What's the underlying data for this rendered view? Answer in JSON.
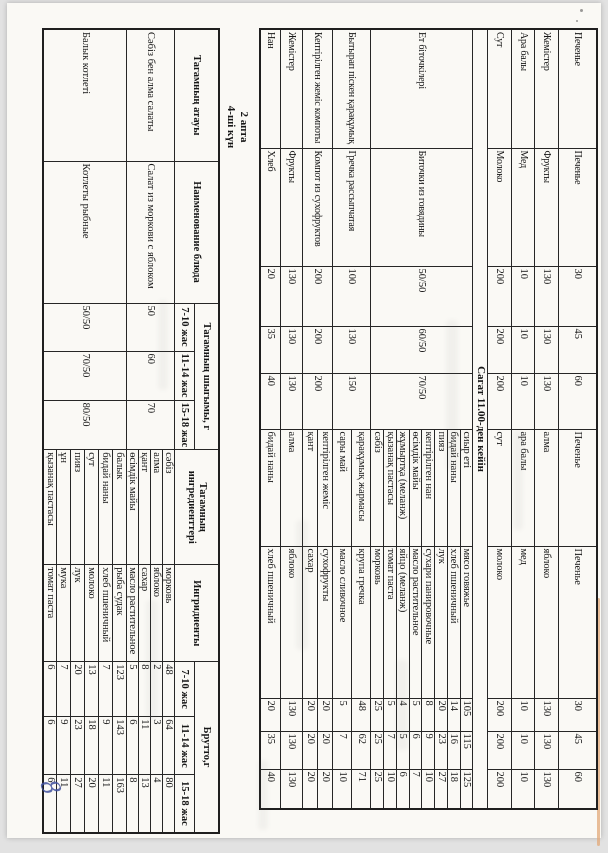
{
  "page": {
    "background_color": "#e2e2e2",
    "paper_color": "#faf9f5",
    "ink_color": "#171717",
    "handwriting_color": "#41519e",
    "handwritten_page_number": "8"
  },
  "menu_table": {
    "rows": [
      {
        "kz": "Печенье",
        "ru": "Печенье",
        "portions": [
          "30",
          "45",
          "60"
        ],
        "ingredients": [
          {
            "kz": "Печенье",
            "ru": "Печенье",
            "brutto": [
              "30",
              "45",
              "60"
            ]
          }
        ]
      },
      {
        "kz": "Жемістер",
        "ru": "Фрукты",
        "portions": [
          "130",
          "130",
          "130"
        ],
        "ingredients": [
          {
            "kz": "алма",
            "ru": "яблоко",
            "brutto": [
              "130",
              "130",
              "130"
            ]
          }
        ]
      },
      {
        "kz": "Ара балы",
        "ru": "Мед",
        "portions": [
          "10",
          "10",
          "10"
        ],
        "ingredients": [
          {
            "kz": "ара балы",
            "ru": "мед",
            "brutto": [
              "10",
              "10",
              "10"
            ]
          }
        ]
      },
      {
        "kz": "Сут",
        "ru": "Молоко",
        "portions": [
          "200",
          "200",
          "200"
        ],
        "ingredients": [
          {
            "kz": "сут",
            "ru": "молоко",
            "brutto": [
              "200",
              "200",
              "200"
            ]
          }
        ]
      },
      {
        "section": "Сагат 11.00-ден кейін"
      },
      {
        "kz": "Ет біточкілері",
        "ru": "Биточки из говядины",
        "portions": [
          "50/50",
          "60/50",
          "70/50"
        ],
        "ingredients": [
          {
            "kz": "сиыр еті",
            "ru": "мясо говяжье",
            "brutto": [
              "105",
              "115",
              "125"
            ]
          },
          {
            "kz": "бидай наны",
            "ru": "хлеб пшеничный",
            "brutto": [
              "14",
              "16",
              "18"
            ]
          },
          {
            "kz": "пияз",
            "ru": "лук",
            "brutto": [
              "20",
              "23",
              "27"
            ]
          },
          {
            "kz": "кептірілген нан",
            "ru": "сухари панировочные",
            "brutto": [
              "8",
              "9",
              "10"
            ]
          },
          {
            "kz": "өсімдік майы",
            "ru": "масло растительное",
            "brutto": [
              "5",
              "6",
              "7"
            ]
          },
          {
            "kz": "жұмыртқа (меланж)",
            "ru": "яйцо (меланж)",
            "brutto": [
              "4",
              "5",
              "6"
            ]
          },
          {
            "kz": "қызанақ пастасы",
            "ru": "томат паста",
            "brutto": [
              "5",
              "7",
              "10"
            ]
          },
          {
            "kz": "сәбіз",
            "ru": "морковь",
            "brutto": [
              "25",
              "25",
              "25"
            ]
          }
        ]
      },
      {
        "kz": "Бытырап піскен қарақұмық",
        "ru": "Гречка рассыпчатая",
        "portions": [
          "100",
          "130",
          "150"
        ],
        "ingredients": [
          {
            "kz": "қарақұмық жармасы",
            "ru": "крупа гречка",
            "brutto": [
              "48",
              "62",
              "71"
            ]
          },
          {
            "kz": "сары май",
            "ru": "масло сливочное",
            "brutto": [
              "5",
              "7",
              "10"
            ]
          }
        ]
      },
      {
        "kz": "Кептірілген жеміс компоты",
        "ru": "Компот из сухофруктов",
        "portions": [
          "200",
          "200",
          "200"
        ],
        "ingredients": [
          {
            "kz": "кептірілген жеміс",
            "ru": "сухофрукты",
            "brutto": [
              "20",
              "20",
              "20"
            ]
          },
          {
            "kz": "қант",
            "ru": "сахар",
            "brutto": [
              "20",
              "20",
              "20"
            ]
          }
        ]
      },
      {
        "kz": "Жемістер",
        "ru": "Фрукты",
        "portions": [
          "130",
          "130",
          "130"
        ],
        "ingredients": [
          {
            "kz": "алма",
            "ru": "яблоко",
            "brutto": [
              "130",
              "130",
              "130"
            ]
          }
        ]
      },
      {
        "kz": "Нан",
        "ru": "Хлеб",
        "portions": [
          "20",
          "35",
          "40"
        ],
        "ingredients": [
          {
            "kz": "бидай наны",
            "ru": "хлеб пшеничный",
            "brutto": [
              "20",
              "35",
              "40"
            ]
          }
        ]
      }
    ]
  },
  "day_table": {
    "week_label": "2 апта",
    "day_label": "4-ші күн",
    "headers": {
      "dish_kz": "Тагамның атауы",
      "dish_ru": "Наименование блюда",
      "output_label": "Тагамның шыгымы, г",
      "ingredients_kz": "Тагамның ингредиенттері",
      "ingredients_ru": "Ингридиенты",
      "brutto_label": "Брутто,г",
      "age_groups": [
        "7-10 жас",
        "11-14 жас",
        "15-18 жас"
      ]
    },
    "rows": [
      {
        "kz": "Сәбіз бен алма  салаты",
        "ru": "Салат из моркови с яблоком",
        "portions": [
          "50",
          "60",
          "70"
        ],
        "ingredients": [
          {
            "kz": "сәбіз",
            "ru": "морковь",
            "brutto": [
              "48",
              "64",
              "80"
            ]
          },
          {
            "kz": "алма",
            "ru": "яблоко",
            "brutto": [
              "2",
              "3",
              "4"
            ]
          },
          {
            "kz": "қант",
            "ru": "сахар",
            "brutto": [
              "8",
              "11",
              "13"
            ]
          },
          {
            "kz": "өсімдік майы",
            "ru": "масло растительное",
            "brutto": [
              "5",
              "6",
              "8"
            ]
          }
        ]
      },
      {
        "kz": "Балык котлеті",
        "ru": "Котлеты рыбные",
        "portions": [
          "50/50",
          "70/50",
          "80/50"
        ],
        "ingredients": [
          {
            "kz": "балык",
            "ru": "рыба судак",
            "brutto": [
              "123",
              "143",
              "163"
            ]
          },
          {
            "kz": "бидай наны",
            "ru": "хлеб пшеничный",
            "brutto": [
              "7",
              "9",
              "11"
            ]
          },
          {
            "kz": "сут",
            "ru": "молоко",
            "brutto": [
              "13",
              "18",
              "20"
            ]
          },
          {
            "kz": "пияз",
            "ru": "лук",
            "brutto": [
              "20",
              "23",
              "27"
            ]
          },
          {
            "kz": "ұн",
            "ru": "мука",
            "brutto": [
              "7",
              "9",
              "11"
            ]
          },
          {
            "kz": "қызанақ пастасы",
            "ru": "томат паста",
            "brutto": [
              "6",
              "6",
              "6"
            ]
          }
        ]
      }
    ]
  }
}
